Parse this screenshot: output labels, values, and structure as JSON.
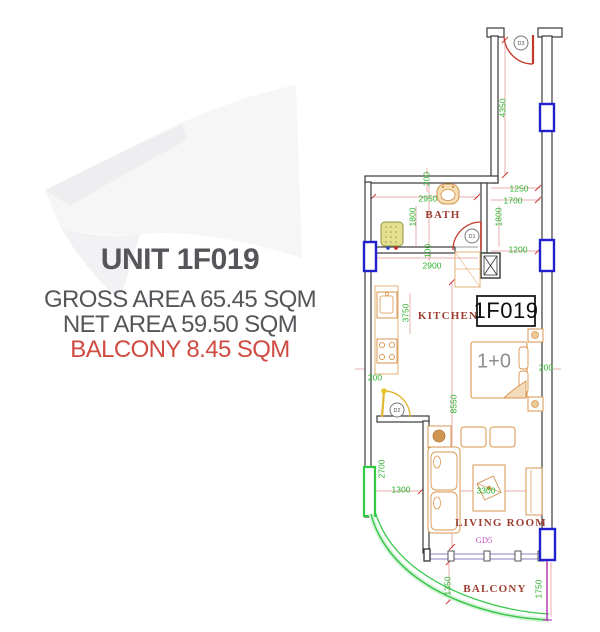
{
  "title_block": {
    "unit_title": "UNIT 1F019",
    "gross_area_line": "GROSS AREA 65.45 SQM",
    "net_area_line": "NET AREA 59.50 SQM",
    "balcony_area_line": "BALCONY 8.45 SQM"
  },
  "plan": {
    "unit_badge": "1F019",
    "bed_type_label": "1+0",
    "glass_door_label": "GD5",
    "room_labels": {
      "bath": "BATH",
      "kitchen": "KITCHEN",
      "living_room": "LIVING ROOM",
      "balcony": "BALCONY"
    },
    "door_tags": {
      "entry": "D3",
      "bath": "D1",
      "hall": "D2"
    },
    "dimensions": [
      {
        "text": "4350"
      },
      {
        "text": "200"
      },
      {
        "text": "2950"
      },
      {
        "text": "1250"
      },
      {
        "text": "1700"
      },
      {
        "text": "1800"
      },
      {
        "text": "1800"
      },
      {
        "text": "1200"
      },
      {
        "text": "100"
      },
      {
        "text": "2900"
      },
      {
        "text": "3750"
      },
      {
        "text": "200"
      },
      {
        "text": "200"
      },
      {
        "text": "8550"
      },
      {
        "text": "2700"
      },
      {
        "text": "1300"
      },
      {
        "text": "3300"
      },
      {
        "text": "1350"
      },
      {
        "text": "1750"
      }
    ]
  },
  "colors": {
    "title_text": "#55565a",
    "balcony_text": "#d04b42",
    "dimension_green": "#2db32d",
    "room_label_red": "#9c3f32",
    "wall_dark": "#3a3a3a",
    "window_blue": "#2020cc",
    "railing_green": "#2ecc3e",
    "door_red": "#c0392b",
    "door_yellow": "#e2b635",
    "furniture_tan": "#d9954f",
    "glass_door_magenta": "#bb44bb"
  }
}
